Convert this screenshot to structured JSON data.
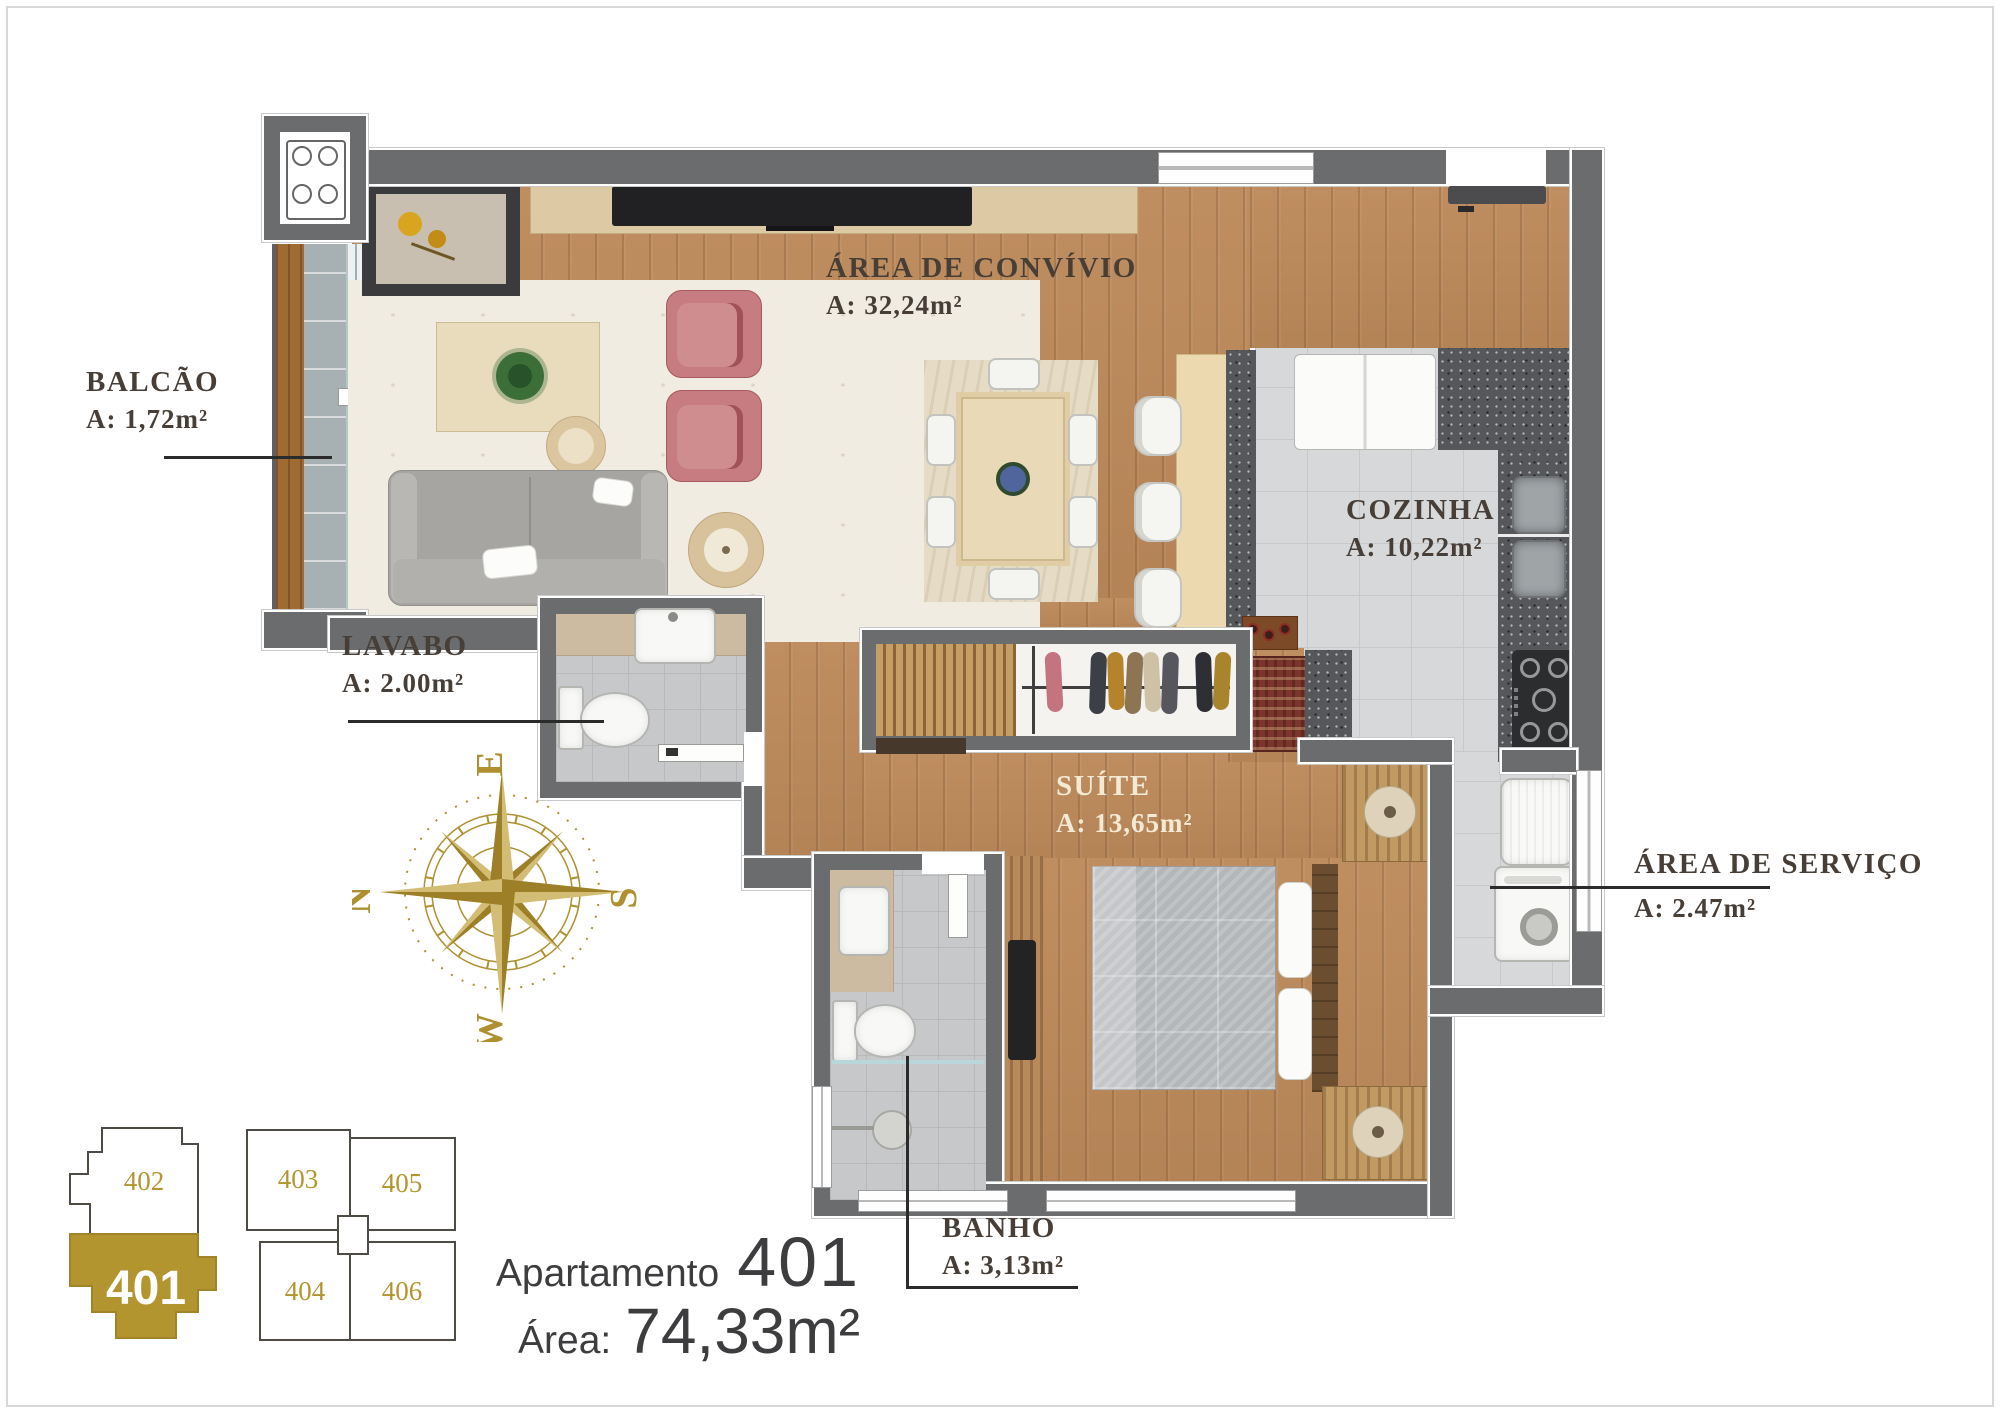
{
  "rooms": {
    "convivio": {
      "name": "ÁREA DE CONVÍVIO",
      "area": "A: 32,24m²"
    },
    "balcao": {
      "name": "BALCÃO",
      "area": "A: 1,72m²"
    },
    "cozinha": {
      "name": "COZINHA",
      "area": "A: 10,22m²"
    },
    "lavabo": {
      "name": "LAVABO",
      "area": "A: 2.00m²"
    },
    "suite": {
      "name": "SUÍTE",
      "area": "A: 13,65m²"
    },
    "servico": {
      "name": "ÁREA DE SERVIÇO",
      "area": "A: 2.47m²"
    },
    "banho": {
      "name": "BANHO",
      "area": "A: 3,13m²"
    }
  },
  "compass": {
    "north": "N",
    "east": "E",
    "south": "S",
    "west": "W",
    "color": "#ae902f"
  },
  "title": {
    "label": "Apartamento",
    "number": "401",
    "area_label": "Área:",
    "area_value": "74,33m²"
  },
  "key_plan": {
    "highlighted_unit": "401",
    "gold": "#b3952f",
    "units": [
      "402",
      "403",
      "405",
      "401",
      "404",
      "406"
    ]
  },
  "colors": {
    "wall": "#6b6c6e",
    "wood_floor": "#bd8a5b",
    "accent_gold": "#b3952f",
    "label_text": "#473f37"
  }
}
